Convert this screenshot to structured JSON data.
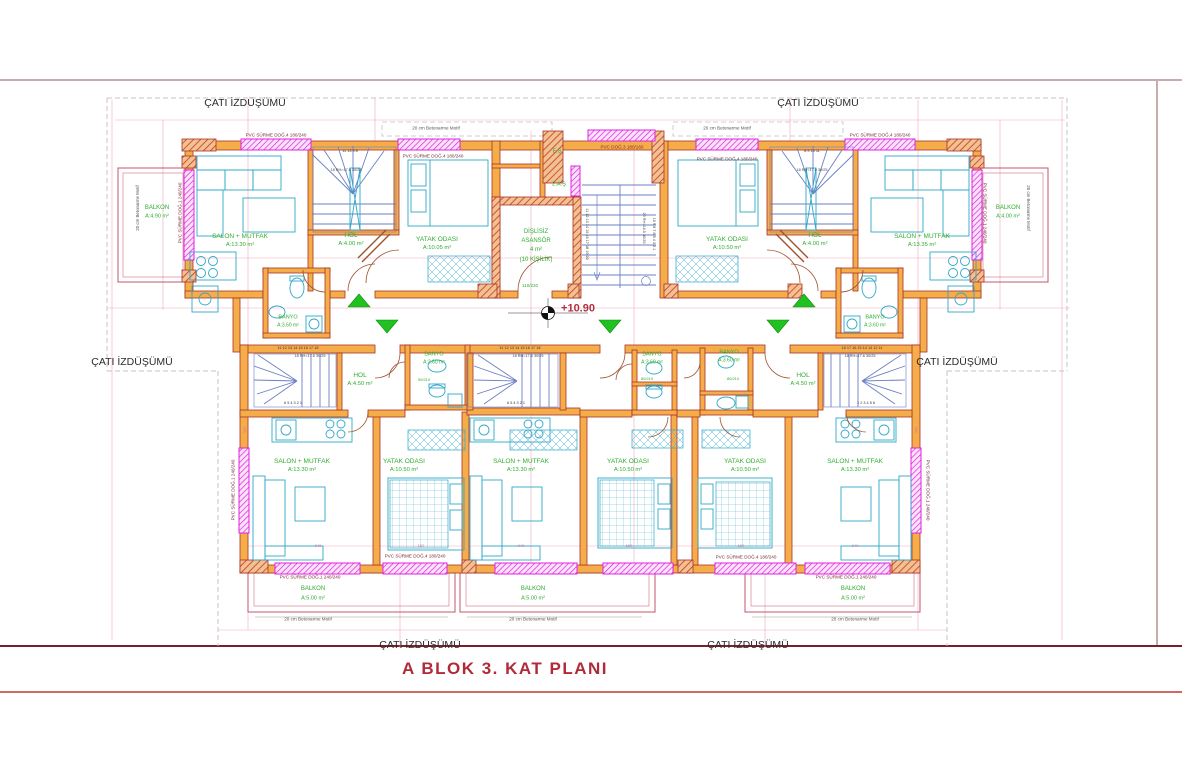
{
  "title": "A BLOK 3. KAT PLANI",
  "colors": {
    "title": "#b02a37",
    "room_label": "#2fae2f",
    "window_label": "#7a2a35",
    "wall_fill": "#f5ad4a",
    "wall_edge": "#a93226",
    "window": "#e020e0",
    "furniture": "#2ea8c8",
    "stair": "#6b7fc4",
    "dimension": "#f2a9bf",
    "arrow": "#21c121",
    "frame_top": "#c9abab",
    "frame_bottom": "#7a1f2b",
    "roof_dash": "#c4c4c4",
    "elevation": "#b03040"
  },
  "plan": {
    "labels": [
      {
        "n": "roof-label-top-left",
        "t": "ÇATI İZDÜŞÜMÜ",
        "x": 245,
        "y": 103,
        "s": 10.5,
        "c": "#2b2b2b"
      },
      {
        "n": "roof-label-top-right",
        "t": "ÇATI İZDÜŞÜMÜ",
        "x": 818,
        "y": 103,
        "s": 10.5,
        "c": "#2b2b2b"
      },
      {
        "n": "roof-label-mid-left",
        "t": "ÇATI İZDÜŞÜMÜ",
        "x": 132,
        "y": 362,
        "s": 10.5,
        "c": "#2b2b2b"
      },
      {
        "n": "roof-label-mid-right",
        "t": "ÇATI İZDÜŞÜMÜ",
        "x": 957,
        "y": 362,
        "s": 10.5,
        "c": "#2b2b2b"
      },
      {
        "n": "roof-label-bottom-left",
        "t": "ÇATI İZDÜŞÜMÜ",
        "x": 420,
        "y": 645,
        "s": 10.5,
        "c": "#2b2b2b"
      },
      {
        "n": "roof-label-bottom-right",
        "t": "ÇATI İZDÜŞÜMÜ",
        "x": 748,
        "y": 645,
        "s": 10.5,
        "c": "#2b2b2b"
      },
      {
        "n": "room-salon-ul",
        "t": "SALON + MUTFAK",
        "x": 240,
        "y": 237,
        "s": 6.5,
        "c": "#2fae2f"
      },
      {
        "n": "room-salon-ul-area",
        "t": "A:13.30 m²",
        "x": 240,
        "y": 246,
        "s": 5.8,
        "c": "#2fae2f"
      },
      {
        "n": "room-hol-ul",
        "t": "HOL",
        "x": 351,
        "y": 236,
        "s": 6.5,
        "c": "#2fae2f"
      },
      {
        "n": "room-hol-ul-area",
        "t": "A:4.00 m²",
        "x": 351,
        "y": 245,
        "s": 5.8,
        "c": "#2fae2f"
      },
      {
        "n": "room-yatak-ul",
        "t": "YATAK ODASI",
        "x": 437,
        "y": 240,
        "s": 6.5,
        "c": "#2fae2f"
      },
      {
        "n": "room-yatak-ul-area",
        "t": "A:10.05 m²",
        "x": 437,
        "y": 249,
        "s": 5.8,
        "c": "#2fae2f"
      },
      {
        "n": "room-banyo-ul",
        "t": "BANYO",
        "x": 288,
        "y": 318,
        "s": 5.5,
        "c": "#2fae2f"
      },
      {
        "n": "room-banyo-ul-area",
        "t": "A:3.60 m²",
        "x": 288,
        "y": 326,
        "s": 5,
        "c": "#2fae2f"
      },
      {
        "n": "room-salon-ur",
        "t": "SALON + MUTFAK",
        "x": 922,
        "y": 237,
        "s": 6.5,
        "c": "#2fae2f"
      },
      {
        "n": "room-salon-ur-area",
        "t": "A:13.35 m²",
        "x": 922,
        "y": 246,
        "s": 5.8,
        "c": "#2fae2f"
      },
      {
        "n": "room-hol-ur",
        "t": "HOL",
        "x": 815,
        "y": 236,
        "s": 6.5,
        "c": "#2fae2f"
      },
      {
        "n": "room-hol-ur-area",
        "t": "A:4.00 m²",
        "x": 815,
        "y": 245,
        "s": 5.8,
        "c": "#2fae2f"
      },
      {
        "n": "room-yatak-ur",
        "t": "YATAK ODASI",
        "x": 727,
        "y": 240,
        "s": 6.5,
        "c": "#2fae2f"
      },
      {
        "n": "room-yatak-ur-area",
        "t": "A:10.50 m²",
        "x": 727,
        "y": 249,
        "s": 5.8,
        "c": "#2fae2f"
      },
      {
        "n": "room-banyo-ur",
        "t": "BANYO",
        "x": 875,
        "y": 318,
        "s": 5.5,
        "c": "#2fae2f"
      },
      {
        "n": "room-banyo-ur-area",
        "t": "A:3.60 m²",
        "x": 875,
        "y": 326,
        "s": 5,
        "c": "#2fae2f"
      },
      {
        "n": "room-balkon-ul",
        "t": "BALKON",
        "x": 157,
        "y": 208,
        "s": 6,
        "c": "#2fae2f"
      },
      {
        "n": "room-balkon-ul-area",
        "t": "A:4.90 m²",
        "x": 157,
        "y": 217,
        "s": 5.5,
        "c": "#2fae2f"
      },
      {
        "n": "room-balkon-ur",
        "t": "BALKON",
        "x": 1008,
        "y": 208,
        "s": 6,
        "c": "#2fae2f"
      },
      {
        "n": "room-balkon-ur-area",
        "t": "A:4.00 m²",
        "x": 1008,
        "y": 217,
        "s": 5.5,
        "c": "#2fae2f"
      },
      {
        "n": "shaft-es",
        "t": "E.Ş",
        "x": 557,
        "y": 152,
        "s": 5.5,
        "c": "#2fae2f"
      },
      {
        "n": "shaft-zas",
        "t": "Z.A.Ş",
        "x": 559,
        "y": 185,
        "s": 5.5,
        "c": "#2fae2f"
      },
      {
        "n": "elevator-line1",
        "t": "DİŞLİSİZ",
        "x": 536,
        "y": 232,
        "s": 6,
        "c": "#2fae2f"
      },
      {
        "n": "elevator-line2",
        "t": "ASANSÖR",
        "x": 536,
        "y": 241,
        "s": 6,
        "c": "#2fae2f"
      },
      {
        "n": "elevator-line3",
        "t": "4 m²",
        "x": 536,
        "y": 250,
        "s": 6,
        "c": "#2fae2f"
      },
      {
        "n": "elevator-line4",
        "t": "(10 KİŞİLİK)",
        "x": 536,
        "y": 260,
        "s": 6,
        "c": "#2fae2f"
      },
      {
        "n": "door-dim-elevator",
        "t": "110/220",
        "x": 530,
        "y": 286,
        "s": 4.5,
        "c": "#2fae2f"
      },
      {
        "n": "elevation-value",
        "t": "+10.90",
        "x": 578,
        "y": 309,
        "s": 11,
        "c": "#b03040",
        "w": 1
      },
      {
        "n": "room-hol-bl",
        "t": "HOL",
        "x": 360,
        "y": 376,
        "s": 6.5,
        "c": "#2fae2f"
      },
      {
        "n": "room-hol-bl-area",
        "t": "A:4.50 m²",
        "x": 360,
        "y": 385,
        "s": 5.8,
        "c": "#2fae2f"
      },
      {
        "n": "room-hol-br",
        "t": "HOL",
        "x": 803,
        "y": 376,
        "s": 6.5,
        "c": "#2fae2f"
      },
      {
        "n": "room-hol-br-area",
        "t": "A:4.50 m²",
        "x": 803,
        "y": 385,
        "s": 5.8,
        "c": "#2fae2f"
      },
      {
        "n": "room-banyo-b1",
        "t": "BANYO",
        "x": 434,
        "y": 355,
        "s": 5.5,
        "c": "#2fae2f"
      },
      {
        "n": "room-banyo-b1-area",
        "t": "A:3.60 m²",
        "x": 434,
        "y": 363,
        "s": 5,
        "c": "#2fae2f"
      },
      {
        "n": "room-banyo-b2",
        "t": "BANYO",
        "x": 652,
        "y": 355,
        "s": 5.5,
        "c": "#2fae2f"
      },
      {
        "n": "room-banyo-b2-area",
        "t": "A:3.60 m²",
        "x": 652,
        "y": 363,
        "s": 5,
        "c": "#2fae2f"
      },
      {
        "n": "room-banyo-b3",
        "t": "BANYO",
        "x": 729,
        "y": 353,
        "s": 5.5,
        "c": "#2fae2f"
      },
      {
        "n": "room-banyo-b3-area",
        "t": "A:3.60 m²",
        "x": 729,
        "y": 361,
        "s": 5,
        "c": "#2fae2f"
      },
      {
        "n": "door-dim-1",
        "t": "90/210",
        "x": 424,
        "y": 380,
        "s": 4,
        "c": "#2fae2f"
      },
      {
        "n": "door-dim-2",
        "t": "80/210",
        "x": 647,
        "y": 379,
        "s": 4,
        "c": "#2fae2f"
      },
      {
        "n": "door-dim-3",
        "t": "80/210",
        "x": 733,
        "y": 379,
        "s": 4,
        "c": "#2fae2f"
      },
      {
        "n": "room-salon-b1",
        "t": "SALON + MUTFAK",
        "x": 302,
        "y": 462,
        "s": 6.5,
        "c": "#2fae2f"
      },
      {
        "n": "room-salon-b1-area",
        "t": "A:13.30 m²",
        "x": 302,
        "y": 471,
        "s": 5.8,
        "c": "#2fae2f"
      },
      {
        "n": "room-yatak-b1",
        "t": "YATAK ODASI",
        "x": 404,
        "y": 462,
        "s": 6.5,
        "c": "#2fae2f"
      },
      {
        "n": "room-yatak-b1-area",
        "t": "A:10.50 m²",
        "x": 404,
        "y": 471,
        "s": 5.8,
        "c": "#2fae2f"
      },
      {
        "n": "room-salon-b2",
        "t": "SALON + MUTFAK",
        "x": 521,
        "y": 462,
        "s": 6.5,
        "c": "#2fae2f"
      },
      {
        "n": "room-salon-b2-area",
        "t": "A:13.30 m²",
        "x": 521,
        "y": 471,
        "s": 5.8,
        "c": "#2fae2f"
      },
      {
        "n": "room-yatak-b2",
        "t": "YATAK ODASI",
        "x": 628,
        "y": 462,
        "s": 6.5,
        "c": "#2fae2f"
      },
      {
        "n": "room-yatak-b2-area",
        "t": "A:10.50 m²",
        "x": 628,
        "y": 471,
        "s": 5.8,
        "c": "#2fae2f"
      },
      {
        "n": "room-yatak-b3",
        "t": "YATAK ODASI",
        "x": 745,
        "y": 462,
        "s": 6.5,
        "c": "#2fae2f"
      },
      {
        "n": "room-yatak-b3-area",
        "t": "A:10.50 m²",
        "x": 745,
        "y": 471,
        "s": 5.8,
        "c": "#2fae2f"
      },
      {
        "n": "room-salon-b3",
        "t": "SALON + MUTFAK",
        "x": 855,
        "y": 462,
        "s": 6.5,
        "c": "#2fae2f"
      },
      {
        "n": "room-salon-b3-area",
        "t": "A:13.30 m²",
        "x": 855,
        "y": 471,
        "s": 5.8,
        "c": "#2fae2f"
      },
      {
        "n": "room-balkon-b1",
        "t": "BALKON",
        "x": 313,
        "y": 589,
        "s": 6,
        "c": "#2fae2f"
      },
      {
        "n": "room-balkon-b1-area",
        "t": "A:5.00 m²",
        "x": 313,
        "y": 599,
        "s": 5.5,
        "c": "#2fae2f"
      },
      {
        "n": "room-balkon-b2",
        "t": "BALKON",
        "x": 533,
        "y": 589,
        "s": 6,
        "c": "#2fae2f"
      },
      {
        "n": "room-balkon-b2-area",
        "t": "A:5.00 m²",
        "x": 533,
        "y": 599,
        "s": 5.5,
        "c": "#2fae2f"
      },
      {
        "n": "room-balkon-b3",
        "t": "BALKON",
        "x": 853,
        "y": 589,
        "s": 6,
        "c": "#2fae2f"
      },
      {
        "n": "room-balkon-b3-area",
        "t": "A:5.00 m²",
        "x": 853,
        "y": 599,
        "s": 5.5,
        "c": "#2fae2f"
      },
      {
        "n": "window-label-1",
        "t": "PVC SÜRME DOĞ.4 180/240",
        "x": 276,
        "y": 136,
        "s": 4.6,
        "c": "#7a2a35"
      },
      {
        "n": "window-label-2",
        "t": "PVC SÜRME DOĞ.4 180/240",
        "x": 433,
        "y": 157,
        "s": 4.6,
        "c": "#7a2a35"
      },
      {
        "n": "window-label-3",
        "t": "PVC DOĞ.3 180/160",
        "x": 622,
        "y": 148,
        "s": 4.6,
        "c": "#7a2a35"
      },
      {
        "n": "window-label-4",
        "t": "PVC SÜRME DOĞ.4 180/240",
        "x": 727,
        "y": 160,
        "s": 4.6,
        "c": "#7a2a35"
      },
      {
        "n": "window-label-5",
        "t": "PVC SÜRME DOĞ.4 180/240",
        "x": 880,
        "y": 136,
        "s": 4.6,
        "c": "#7a2a35"
      },
      {
        "n": "window-label-6",
        "t": "PVC SÜRME DOĞ.1 240/240",
        "x": 181,
        "y": 213,
        "s": 4.6,
        "c": "#7a2a35",
        "r": -90
      },
      {
        "n": "window-label-7",
        "t": "PVC SÜRME DOĞ.1 240/240",
        "x": 984,
        "y": 213,
        "s": 4.6,
        "c": "#7a2a35",
        "r": 90
      },
      {
        "n": "window-label-8",
        "t": "PVC SÜRME DOĞ.1 240/240",
        "x": 310,
        "y": 578,
        "s": 4.6,
        "c": "#7a2a35"
      },
      {
        "n": "window-label-9",
        "t": "PVC SÜRME DOĞ.4 180/240",
        "x": 415,
        "y": 557,
        "s": 4.6,
        "c": "#7a2a35"
      },
      {
        "n": "window-label-10",
        "t": "PVC SÜRME DOĞ.4 180/240",
        "x": 746,
        "y": 558,
        "s": 4.6,
        "c": "#7a2a35"
      },
      {
        "n": "window-label-11",
        "t": "PVC SÜRME DOĞ.1 240/240",
        "x": 846,
        "y": 578,
        "s": 4.6,
        "c": "#7a2a35"
      },
      {
        "n": "window-label-12",
        "t": "PVC SÜRME DOĞ.1 240/240",
        "x": 234,
        "y": 490,
        "s": 4.6,
        "c": "#7a2a35",
        "r": -90
      },
      {
        "n": "window-label-13",
        "t": "PVC SÜRME DOĞ.1 240/240",
        "x": 927,
        "y": 490,
        "s": 4.6,
        "c": "#7a2a35",
        "r": 90
      },
      {
        "n": "concrete-motif-1",
        "t": "20 cm Betonarme Motif",
        "x": 436,
        "y": 129,
        "s": 4.6,
        "c": "#555555"
      },
      {
        "n": "concrete-motif-2",
        "t": "20 cm Betonarme Motif",
        "x": 727,
        "y": 129,
        "s": 4.6,
        "c": "#555555"
      },
      {
        "n": "concrete-motif-3",
        "t": "20 cm Betonarme Motif",
        "x": 308,
        "y": 620,
        "s": 4.6,
        "c": "#555555"
      },
      {
        "n": "concrete-motif-4",
        "t": "20 cm Betonarme Motif",
        "x": 533,
        "y": 620,
        "s": 4.6,
        "c": "#555555"
      },
      {
        "n": "concrete-motif-5",
        "t": "20 cm Betonarme Motif",
        "x": 855,
        "y": 620,
        "s": 4.6,
        "c": "#555555"
      },
      {
        "n": "concrete-motif-6",
        "t": "20 cm Betonarme Motif",
        "x": 138,
        "y": 208,
        "s": 4.4,
        "c": "#555555",
        "r": -90
      },
      {
        "n": "concrete-motif-7",
        "t": "20 cm Betonarme Motif",
        "x": 1028,
        "y": 208,
        "s": 4.4,
        "c": "#555555",
        "r": 90
      },
      {
        "n": "stair-spec-ul",
        "t": "18 RH=17.6  30/25",
        "x": 346,
        "y": 171,
        "s": 3.8,
        "c": "#444444"
      },
      {
        "n": "stair-spec-ur",
        "t": "18 RH=17.6  30/25",
        "x": 812,
        "y": 171,
        "s": 3.8,
        "c": "#444444"
      },
      {
        "n": "stair-spec-b1",
        "t": "18 RH=17.6  30/25",
        "x": 310,
        "y": 357,
        "s": 3.8,
        "c": "#444444"
      },
      {
        "n": "stair-spec-b2",
        "t": "18 RH=17.6  30/25",
        "x": 528,
        "y": 357,
        "s": 3.8,
        "c": "#444444"
      },
      {
        "n": "stair-spec-b3",
        "t": "18 RH=17.6  30/25",
        "x": 860,
        "y": 357,
        "s": 3.8,
        "c": "#444444"
      },
      {
        "n": "stair-spec-core",
        "t": "20 RH=16.5  30/25",
        "x": 643,
        "y": 228,
        "s": 3.8,
        "c": "#444444",
        "r": 90
      },
      {
        "n": "stair-steps-core-left",
        "t": "11 12 13 14 15 16 17 18 19 20",
        "x": 586,
        "y": 234,
        "s": 3.8,
        "c": "#333333",
        "r": 90
      },
      {
        "n": "stair-steps-core-right",
        "t": "10 9 8 7 6 5 4 3 2 1",
        "x": 653,
        "y": 234,
        "s": 3.8,
        "c": "#333333",
        "r": 90
      },
      {
        "n": "stair-steps-ul",
        "t": "11  13  9  8",
        "x": 350,
        "y": 152,
        "s": 3.8,
        "c": "#333333"
      },
      {
        "n": "stair-steps-ur",
        "t": "8  9  13  11",
        "x": 812,
        "y": 152,
        "s": 3.8,
        "c": "#333333"
      },
      {
        "n": "stair-steps-b1-top",
        "t": "11 12 13 14 15 16 17 18",
        "x": 298,
        "y": 349,
        "s": 3.8,
        "c": "#333333"
      },
      {
        "n": "stair-steps-b2-top",
        "t": "11 12 13 14 15 16 17 18",
        "x": 520,
        "y": 349,
        "s": 3.8,
        "c": "#333333"
      },
      {
        "n": "stair-steps-b3-top",
        "t": "18 17 16 15 14 13 12 11",
        "x": 862,
        "y": 349,
        "s": 3.8,
        "c": "#333333"
      },
      {
        "n": "stair-steps-b1-bottom",
        "t": "6 5 4 3 2 1",
        "x": 293,
        "y": 404,
        "s": 3.8,
        "c": "#333333"
      },
      {
        "n": "stair-steps-b2-bottom",
        "t": "6 5 4 3 2 1",
        "x": 516,
        "y": 404,
        "s": 3.8,
        "c": "#333333"
      },
      {
        "n": "stair-steps-b3-bottom",
        "t": "1 2 3 4 5 6",
        "x": 866,
        "y": 404,
        "s": 3.8,
        "c": "#333333"
      },
      {
        "n": "dim-1",
        "t": "240",
        "x": 318,
        "y": 546,
        "s": 4,
        "c": "#d4768f"
      },
      {
        "n": "dim-2",
        "t": "160",
        "x": 421,
        "y": 546,
        "s": 4,
        "c": "#d4768f"
      },
      {
        "n": "dim-3",
        "t": "240",
        "x": 521,
        "y": 546,
        "s": 4,
        "c": "#d4768f"
      },
      {
        "n": "dim-4",
        "t": "160",
        "x": 629,
        "y": 546,
        "s": 4,
        "c": "#d4768f"
      },
      {
        "n": "dim-5",
        "t": "160",
        "x": 741,
        "y": 546,
        "s": 4,
        "c": "#d4768f"
      },
      {
        "n": "dim-6",
        "t": "240",
        "x": 855,
        "y": 546,
        "s": 4,
        "c": "#d4768f"
      },
      {
        "n": "dim-7",
        "t": "300",
        "x": 245,
        "y": 430,
        "s": 4,
        "c": "#d4768f",
        "r": -90
      },
      {
        "n": "dim-8",
        "t": "300",
        "x": 916,
        "y": 430,
        "s": 4,
        "c": "#d4768f",
        "r": 90
      }
    ]
  }
}
